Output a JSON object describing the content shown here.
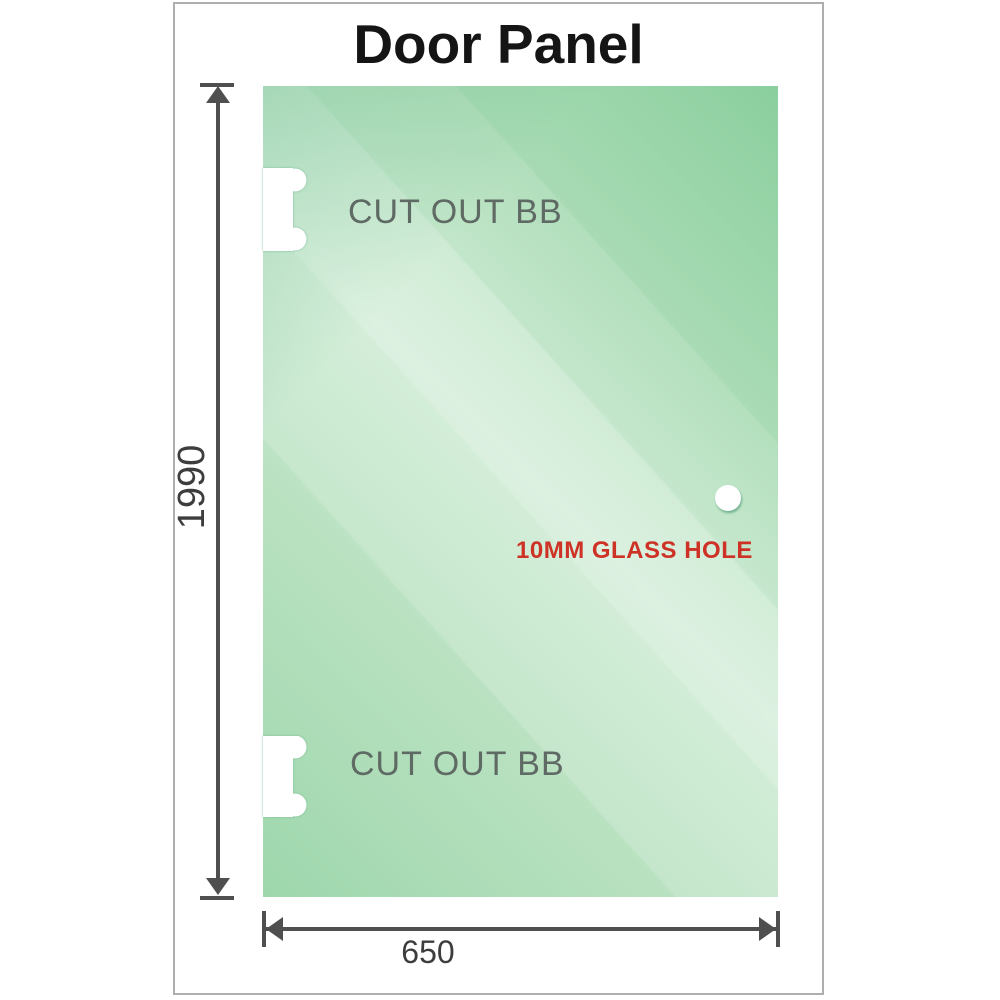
{
  "title": "Door Panel",
  "panel": {
    "cutouts": [
      {
        "label": "CUT OUT BB",
        "position": "top-left"
      },
      {
        "label": "CUT OUT BB",
        "position": "bottom-left"
      }
    ],
    "glass_hole": {
      "label": "10MM GLASS HOLE"
    }
  },
  "dimensions": {
    "height": {
      "value": "1990",
      "orientation": "vertical"
    },
    "width": {
      "value": "650",
      "orientation": "horizontal"
    }
  },
  "colors": {
    "glass_base": "#8ccfa0",
    "glass_highlight": "#cdebd3",
    "hole_label_red": "#ce3226",
    "dimension_gray": "#4f4f4f",
    "cutout_label_gray": "#5f6a64",
    "title_black": "#151515",
    "frame_border": "#aeaeae"
  }
}
